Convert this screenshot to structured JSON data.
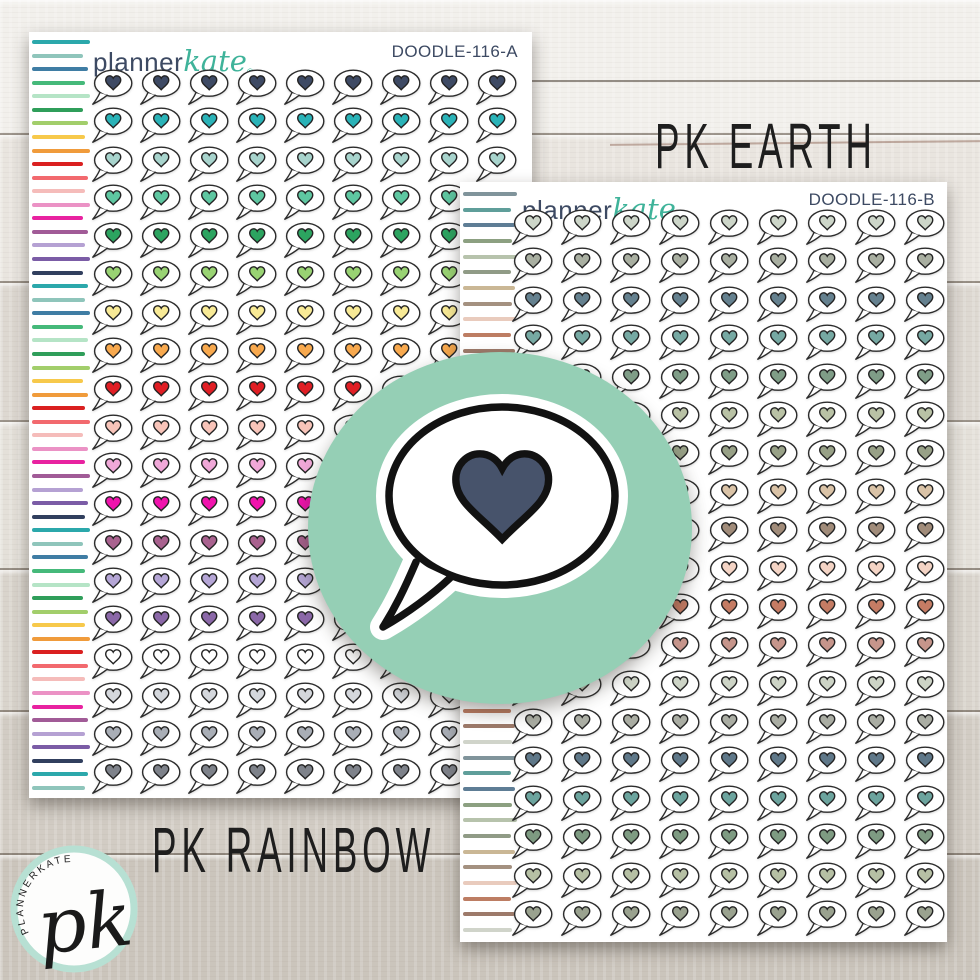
{
  "product": {
    "sheet_a": {
      "brand_first": "planner",
      "brand_second": "kate",
      "reg_mark": "®",
      "code": "DOODLE-116-A",
      "caption": "PK RAINBOW",
      "columns": 9,
      "rows": 19,
      "heart_row_colors": [
        "#3e4a64",
        "#2ab3b8",
        "#a8d4cd",
        "#5ec7a1",
        "#2ca460",
        "#99d373",
        "#f8ea96",
        "#f8a94e",
        "#e01e24",
        "#f8c4b9",
        "#f0a8d8",
        "#f013ad",
        "#a9628f",
        "#b5a6d6",
        "#8b68a8",
        "#ffffff",
        "#d4d7dc",
        "#a9aeb6",
        "#7e828a"
      ],
      "stripe_colors": [
        "#2ba8ab",
        "#8fc5bb",
        "#3f7da4",
        "#45b97a",
        "#b5e4c6",
        "#2f9e5a",
        "#a2ce6b",
        "#f7c94b",
        "#f09b3b",
        "#da2020",
        "#f2696e",
        "#f5bcba",
        "#eb92c5",
        "#e822a0",
        "#a15b97",
        "#b5a1d3",
        "#7b5ca6",
        "#313f5e"
      ],
      "stripe_count": 56
    },
    "sheet_b": {
      "brand_first": "planner",
      "brand_second": "kate",
      "reg_mark": "®",
      "code": "DOODLE-116-B",
      "caption": "PK EARTH",
      "columns": 9,
      "rows": 19,
      "heart_row_colors": [
        "#cdd6c9",
        "#a9afa1",
        "#65818f",
        "#76a9a3",
        "#7f9d87",
        "#b9c2a5",
        "#98a187",
        "#dac3a7",
        "#a18c7a",
        "#f4d4c5",
        "#c57c64",
        "#c6958b",
        "#cdd4c6",
        "#aaada3",
        "#5f7889",
        "#6ca49e",
        "#7e9b82",
        "#b6c0a4",
        "#9aa28f"
      ],
      "stripe_colors": [
        "#80949b",
        "#5f9e9a",
        "#5e7d95",
        "#8ca081",
        "#b7c3ac",
        "#909b86",
        "#cab795",
        "#a49180",
        "#e9cbbd",
        "#bd7d63",
        "#9d7a6a",
        "#d0d4ca"
      ],
      "stripe_count": 48
    },
    "center_badge": {
      "circle_color": "#95cfb5",
      "bubble_fill": "#ffffff",
      "outline_color": "#121212",
      "heart_color": "#47536b"
    },
    "corner_logo": {
      "initials": "pk",
      "arc_text": "PLANNERKATE",
      "ring_color": "#b7e0d3"
    },
    "bubble_outline_color": "#2c2c2c"
  }
}
